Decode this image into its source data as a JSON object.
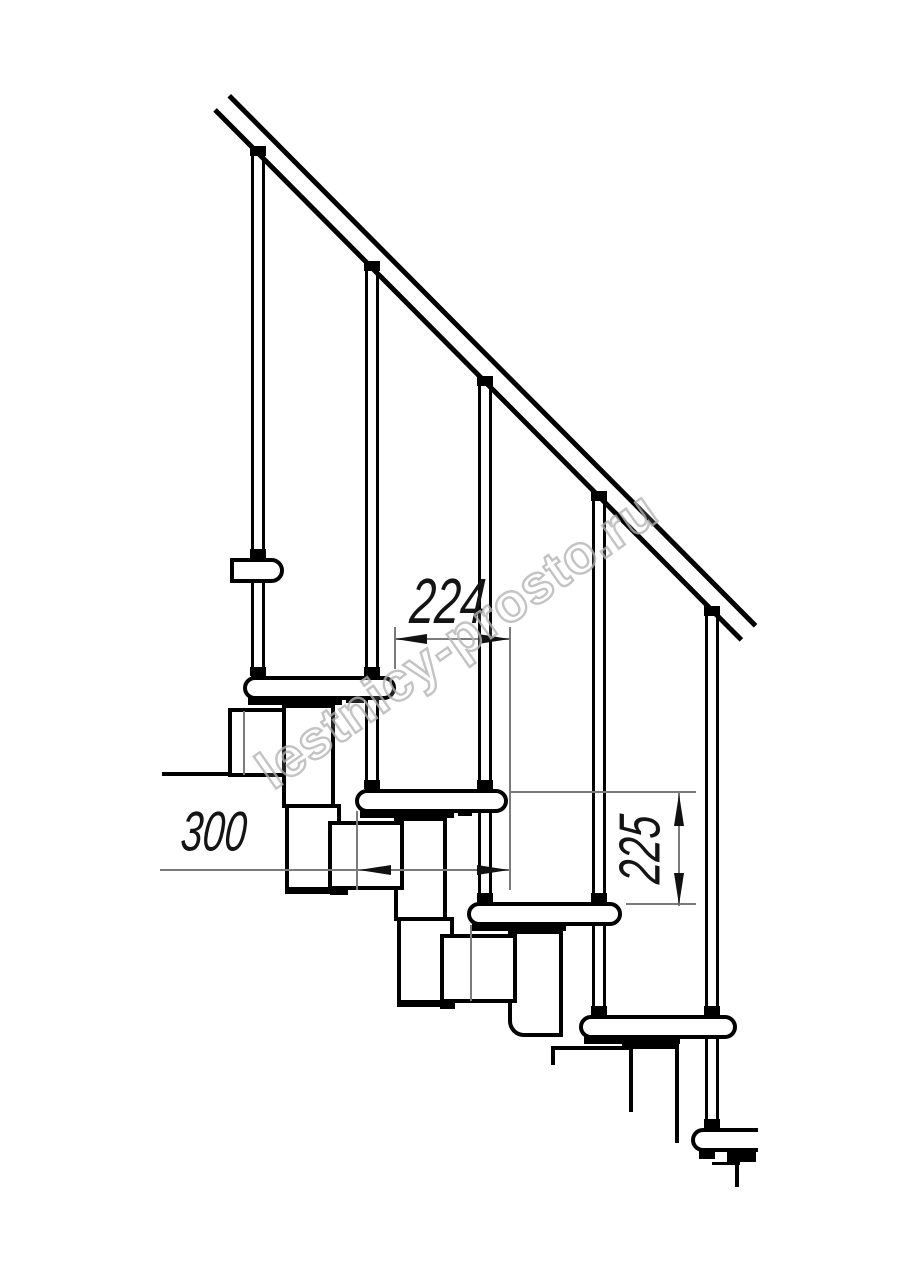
{
  "meta": {
    "description": "Side-view technical drawing of a modular staircase with handrail, balusters, treads and step modules"
  },
  "dimensions": {
    "dim_224": {
      "label": "224"
    },
    "dim_300": {
      "label": "300"
    },
    "dim_225": {
      "label": "225"
    }
  },
  "watermark": {
    "text": "lestnicy-prosto.ru"
  },
  "colors": {
    "line": "#000000",
    "dimension_line": "#7b7b7b",
    "watermark": "#b5b5b5",
    "background": "#ffffff"
  }
}
